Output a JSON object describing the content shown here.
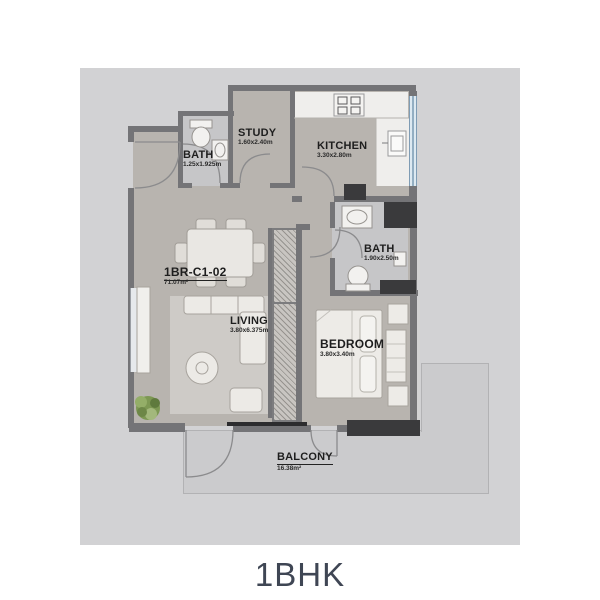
{
  "title": "1BHK",
  "unit": {
    "code": "1BR-C1-02",
    "area": "71.07m²"
  },
  "rooms": {
    "bath1": {
      "name": "BATH",
      "dims": "1.25x1.925m"
    },
    "study": {
      "name": "STUDY",
      "dims": "1.60x2.40m"
    },
    "kitchen": {
      "name": "KITCHEN",
      "dims": "3.30x2.80m"
    },
    "bath2": {
      "name": "BATH",
      "dims": "1.90x2.50m"
    },
    "living": {
      "name": "LIVING",
      "dims": "3.80x6.375m"
    },
    "bedroom": {
      "name": "BEDROOM",
      "dims": "3.80x3.40m"
    },
    "balcony": {
      "name": "BALCONY",
      "dims": "16.38m²"
    }
  },
  "colors": {
    "backdrop": "#d2d2d4",
    "floor": "#b8b4af",
    "bath_floor": "#c6c6c8",
    "balcony_floor": "#cbcbcd",
    "wall": "#747477",
    "wall_dark": "#3a3a3c",
    "window_blue": "#dde9f1",
    "plant_green": "#7e9a55",
    "label_text": "#1e1e1e",
    "title_text": "#3f4654"
  }
}
